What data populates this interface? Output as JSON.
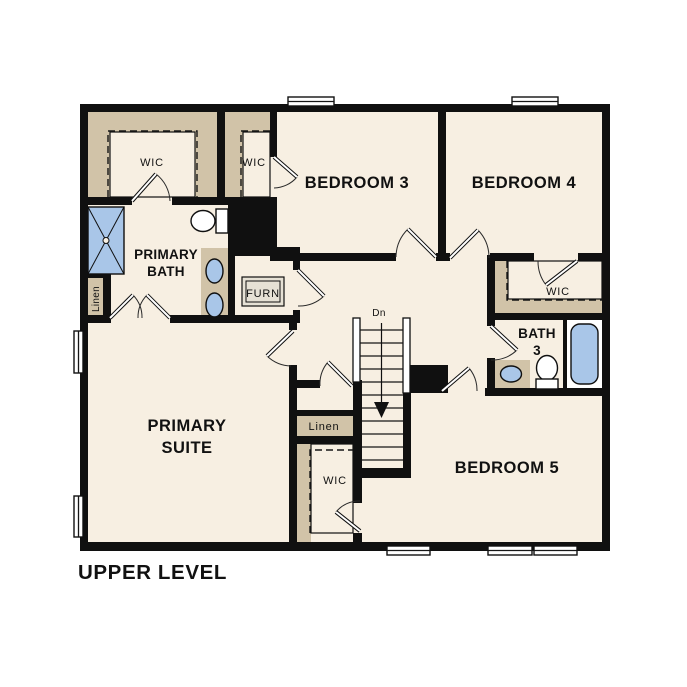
{
  "floor_plan": {
    "title": "UPPER LEVEL",
    "rooms": {
      "bedroom3": "BEDROOM 3",
      "bedroom4": "BEDROOM 4",
      "bedroom5": "BEDROOM 5",
      "primary_suite": {
        "line1": "PRIMARY",
        "line2": "SUITE"
      },
      "primary_bath": {
        "line1": "PRIMARY",
        "line2": "BATH"
      },
      "bath3": {
        "line1": "BATH",
        "line2": "3"
      }
    },
    "closets": {
      "walk_in_closet": "WIC",
      "linen": "Linen",
      "furnace": "FURN"
    },
    "stairs": {
      "down_label": "Dn"
    },
    "colors": {
      "wall": "#101010",
      "floor": "#f7efe2",
      "shelf_tan": "#d1c3a8",
      "fixture_blue": "#a9c6e8",
      "page_background": "#ffffff"
    }
  }
}
